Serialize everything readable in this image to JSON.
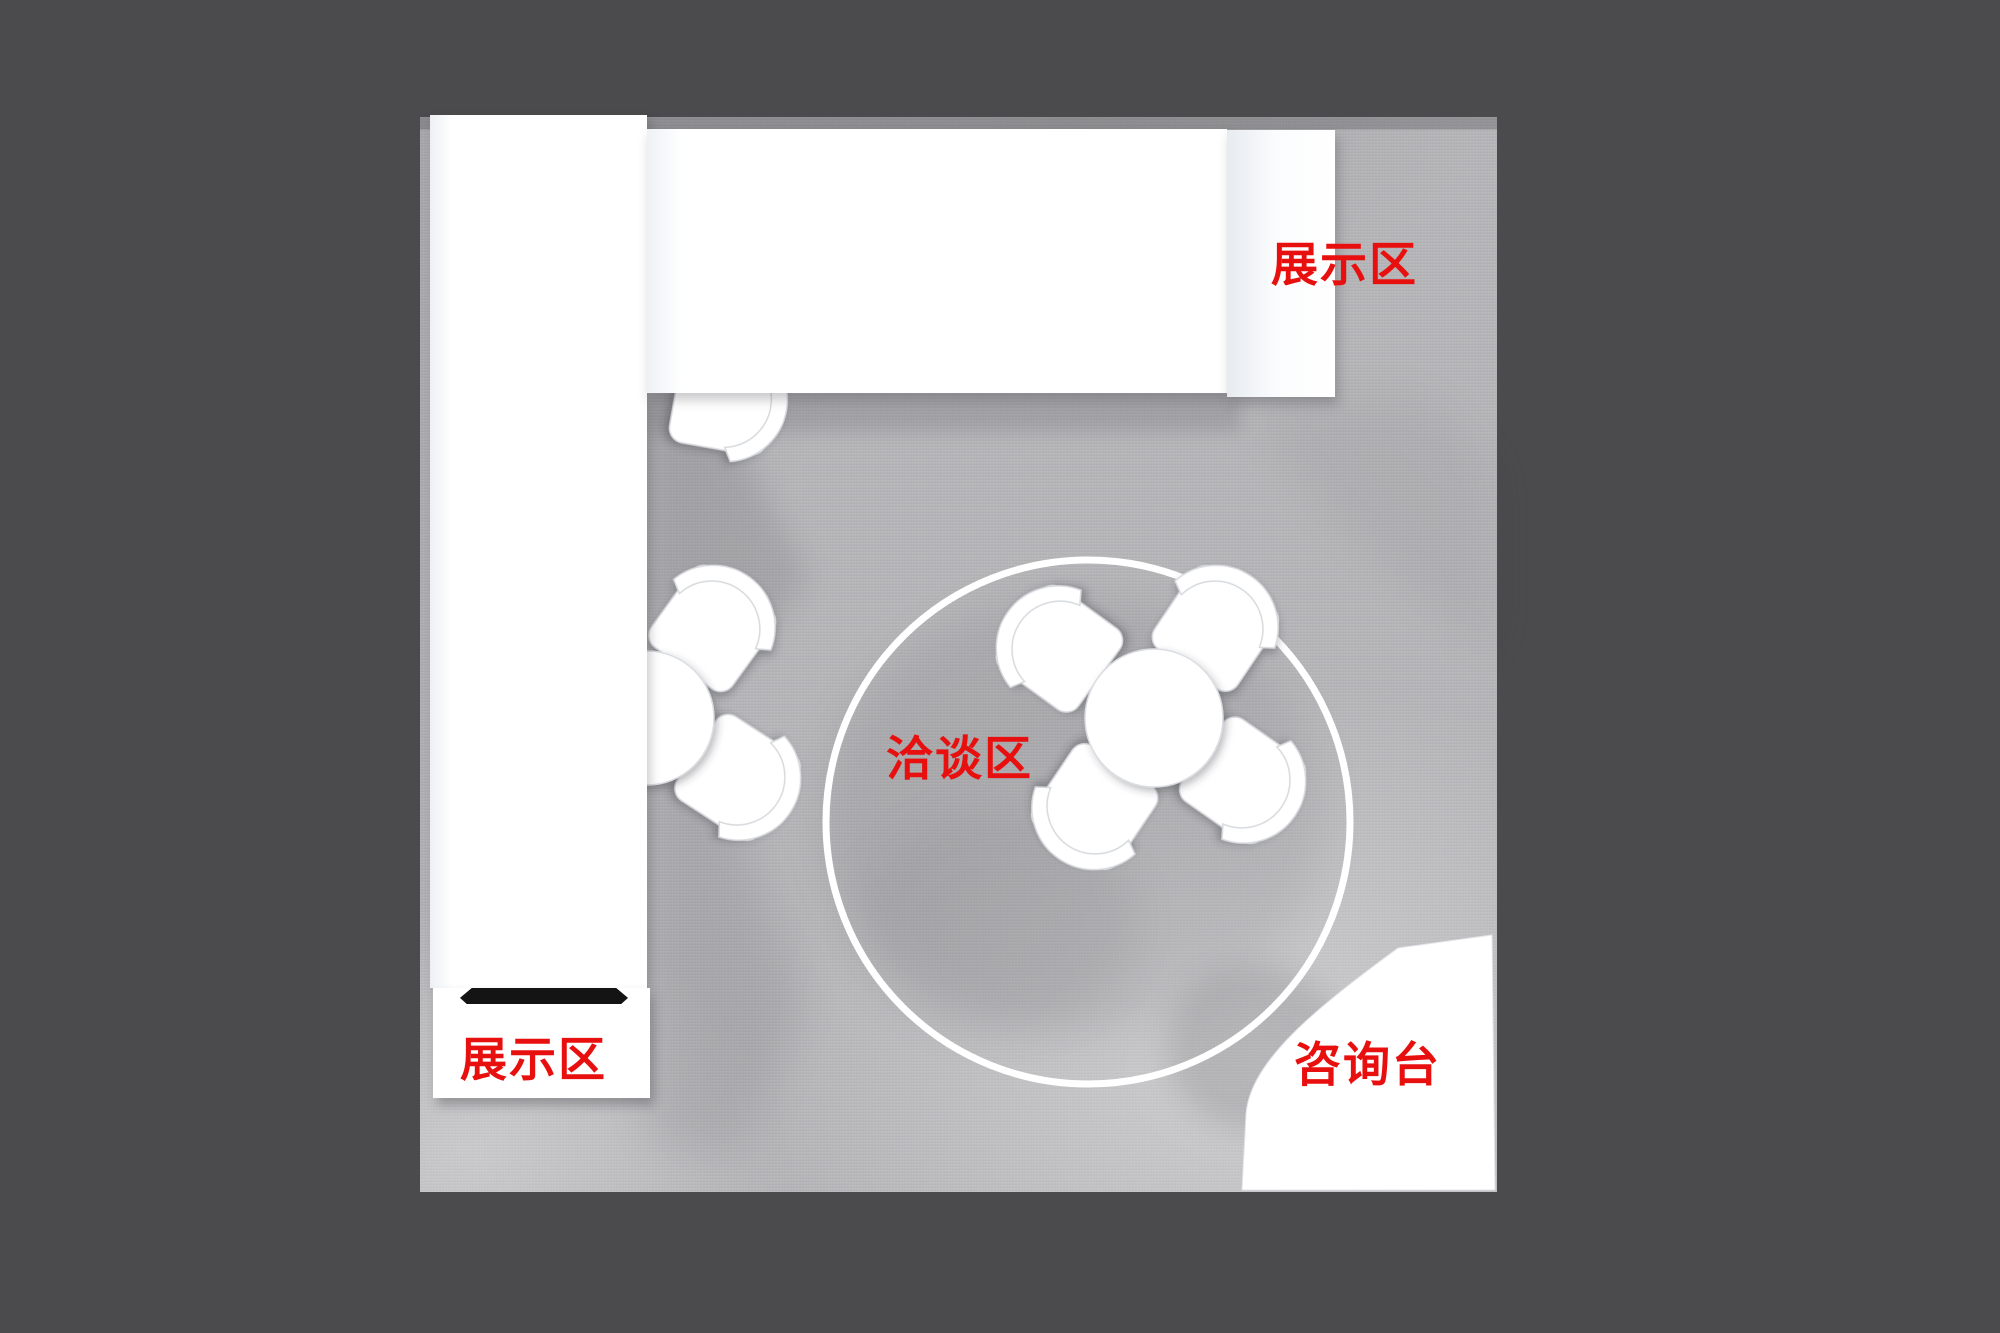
{
  "scene": {
    "description": "Top-down 3D render of an exhibition booth floor plan",
    "colors": {
      "background": "#4b4b4d",
      "floor": "#b4b4b7",
      "furniture": "#ffffff",
      "label_red": "#e8100e",
      "shelf_bar": "#141414"
    }
  },
  "zones": {
    "display_area_top": {
      "label": "展示区"
    },
    "display_area_left": {
      "label": "展示区"
    },
    "negotiation_area": {
      "label": "洽谈区"
    },
    "information_desk": {
      "label": "咨询台"
    }
  }
}
